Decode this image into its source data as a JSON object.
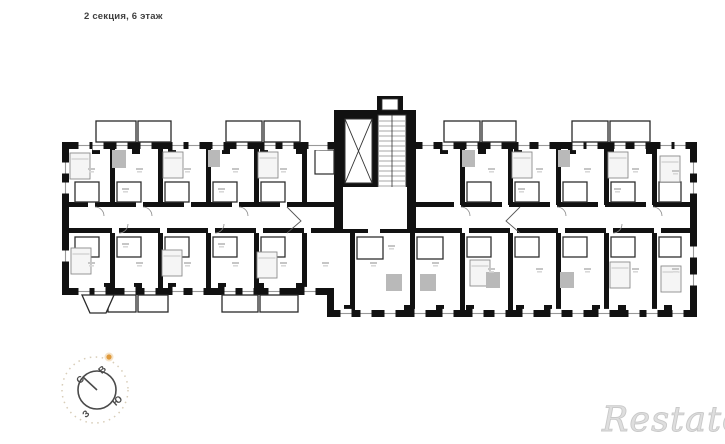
{
  "header": {
    "title": "2 секция, 6 этаж"
  },
  "compass": {
    "north": "С",
    "east": "В",
    "south": "Ю",
    "west": "З"
  },
  "watermark": {
    "text": "Restate"
  },
  "colors": {
    "wall": "#111111",
    "accent_dot": "#e09a3c",
    "watermark_gray": "#c9c9c9"
  }
}
